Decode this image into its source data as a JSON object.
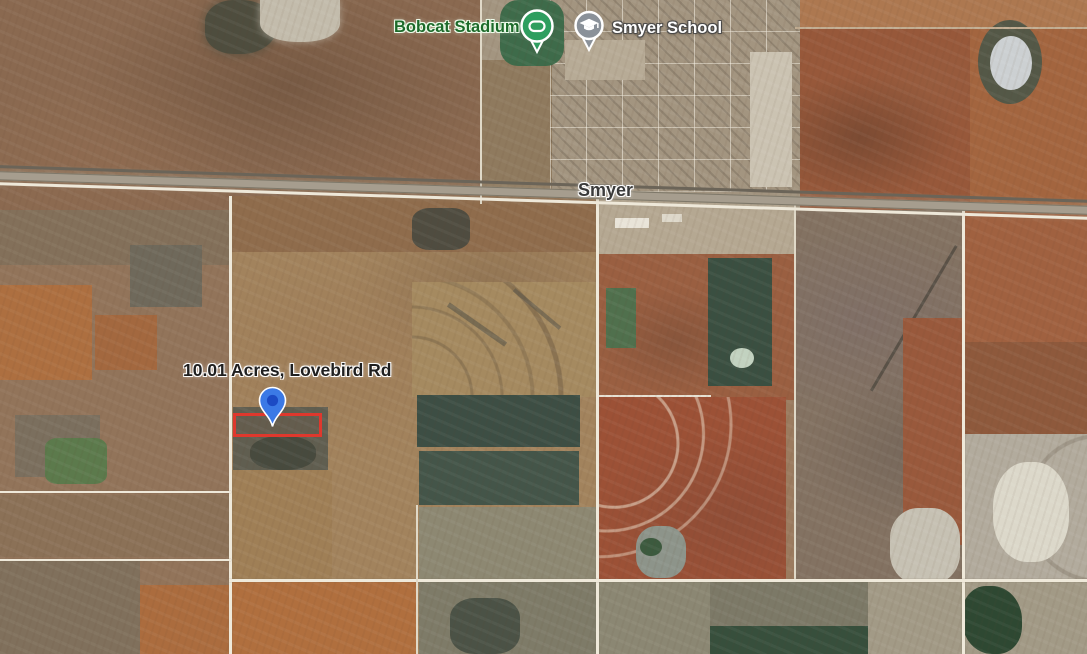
{
  "map": {
    "view_type": "satellite",
    "town_label": "Smyer",
    "poi": {
      "stadium": {
        "label": "Bobcat Stadium"
      },
      "school": {
        "label": "Smyer School"
      }
    },
    "property": {
      "label": "10.01 Acres, Lovebird Rd"
    },
    "colors": {
      "property_outline": "#df382d",
      "property_pin": "#3b79e6",
      "property_pin_dot": "#1c4ac4",
      "stadium_pin": "#2e9e5f",
      "school_pin": "#8a9199",
      "stadium_label": "#1d6a2a"
    }
  }
}
